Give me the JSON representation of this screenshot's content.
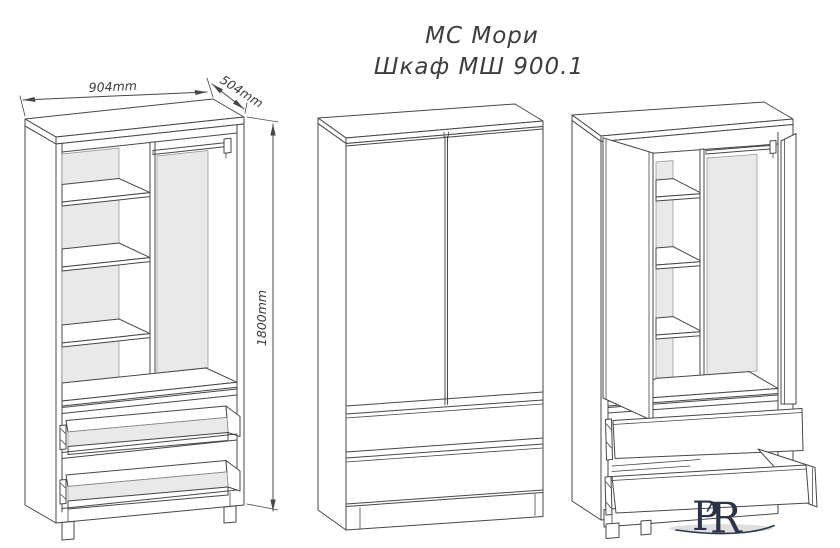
{
  "title": {
    "line1": "МС Мори",
    "line2": "Шкаф МШ 900.1"
  },
  "dimensions": {
    "width": "904mm",
    "depth": "504mm",
    "height": "1800mm"
  },
  "logo": {
    "letter_p": "P",
    "letter_r": "R"
  },
  "colors": {
    "line": "#474747",
    "panel_gray": "#e9e9e9",
    "logo_navy": "#2b3347",
    "shadow_gray": "#c9c9c9",
    "background": "#ffffff"
  }
}
